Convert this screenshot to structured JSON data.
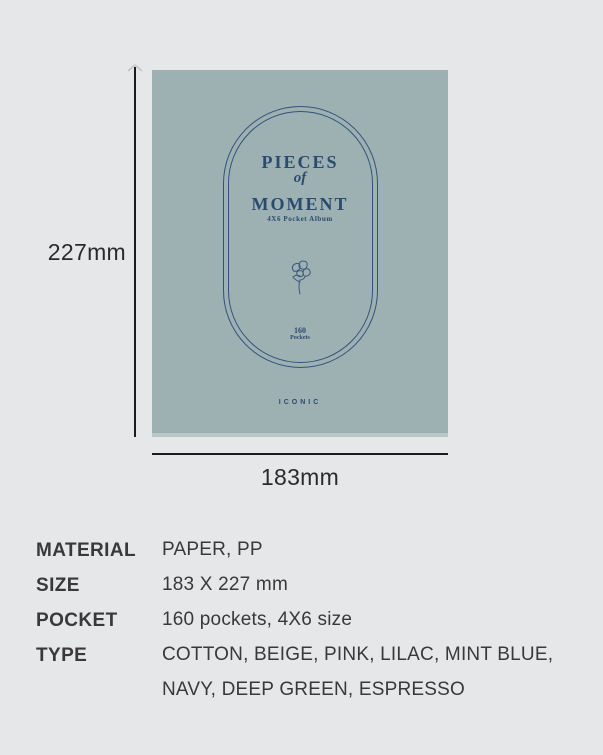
{
  "colors": {
    "page_background": "#e6e7e9",
    "cover_background": "#9db1b3",
    "cover_accent_navy": "#2c4a6e",
    "annotation_ink": "#2b2b2e",
    "spec_text": "#39393b"
  },
  "cover": {
    "title_line1": "PIECES",
    "title_line2": "of",
    "title_line3": "MOMENT",
    "subtitle": "4X6 Pocket Album",
    "pocket_count": "160",
    "pocket_count_label": "Pockets",
    "brand": "ICONIC",
    "center_icon": "flower-sketch-icon"
  },
  "dimensions": {
    "height_label": "227mm",
    "width_label": "183mm"
  },
  "specs": {
    "rows": [
      {
        "label": "MATERIAL",
        "value": "PAPER, PP"
      },
      {
        "label": "SIZE",
        "value": "183 X 227 mm"
      },
      {
        "label": "POCKET",
        "value": "160 pockets, 4X6 size"
      },
      {
        "label": "TYPE",
        "value": "COTTON, BEIGE, PINK, LILAC, MINT BLUE,",
        "value2": "NAVY, DEEP GREEN, ESPRESSO"
      }
    ]
  }
}
